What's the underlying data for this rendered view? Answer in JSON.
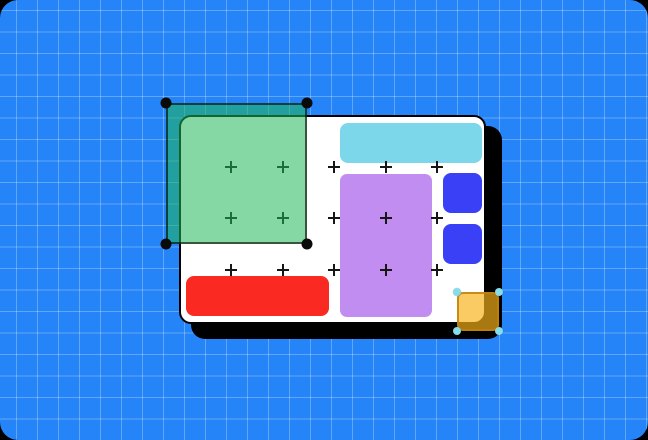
{
  "scene": {
    "description": "Illustration of a design-tool canvas: blueprint grid, white artboard with shapes, a green selection marquee and a selected yellow square",
    "colors": {
      "outer": "#000000",
      "background": "#2584F7",
      "grid_line": "rgba(255,255,255,0.28)",
      "board_fill": "#FFFFFF",
      "board_outline": "#000000",
      "board_shadow": "#000000",
      "marker": "#161616"
    },
    "shapes": {
      "cyan_bar": {
        "name": "cyan-bar",
        "color": "#7BD7E9"
      },
      "purple_rect": {
        "name": "purple-rectangle",
        "color": "#C18DF0"
      },
      "blue_square_top": {
        "name": "blue-square-top",
        "color": "#3A40F6"
      },
      "blue_square_bottom": {
        "name": "blue-square-bottom",
        "color": "#3A40F6"
      },
      "red_bar": {
        "name": "red-bar",
        "color": "#FA2A22"
      }
    },
    "selection_green": {
      "fill": "rgba(33,182,88,0.55)",
      "border": "rgba(0,0,0,0.6)",
      "handle_color": "#0A0A0A"
    },
    "selection_yellow": {
      "fill": "rgba(247,179,24,0.68)",
      "border": "rgba(193,128,8,0.85)",
      "handle_color": "#85DCEA"
    },
    "markers": {
      "columns": [
        231,
        283,
        334,
        386,
        437
      ],
      "rows": [
        167,
        218,
        270
      ]
    }
  }
}
